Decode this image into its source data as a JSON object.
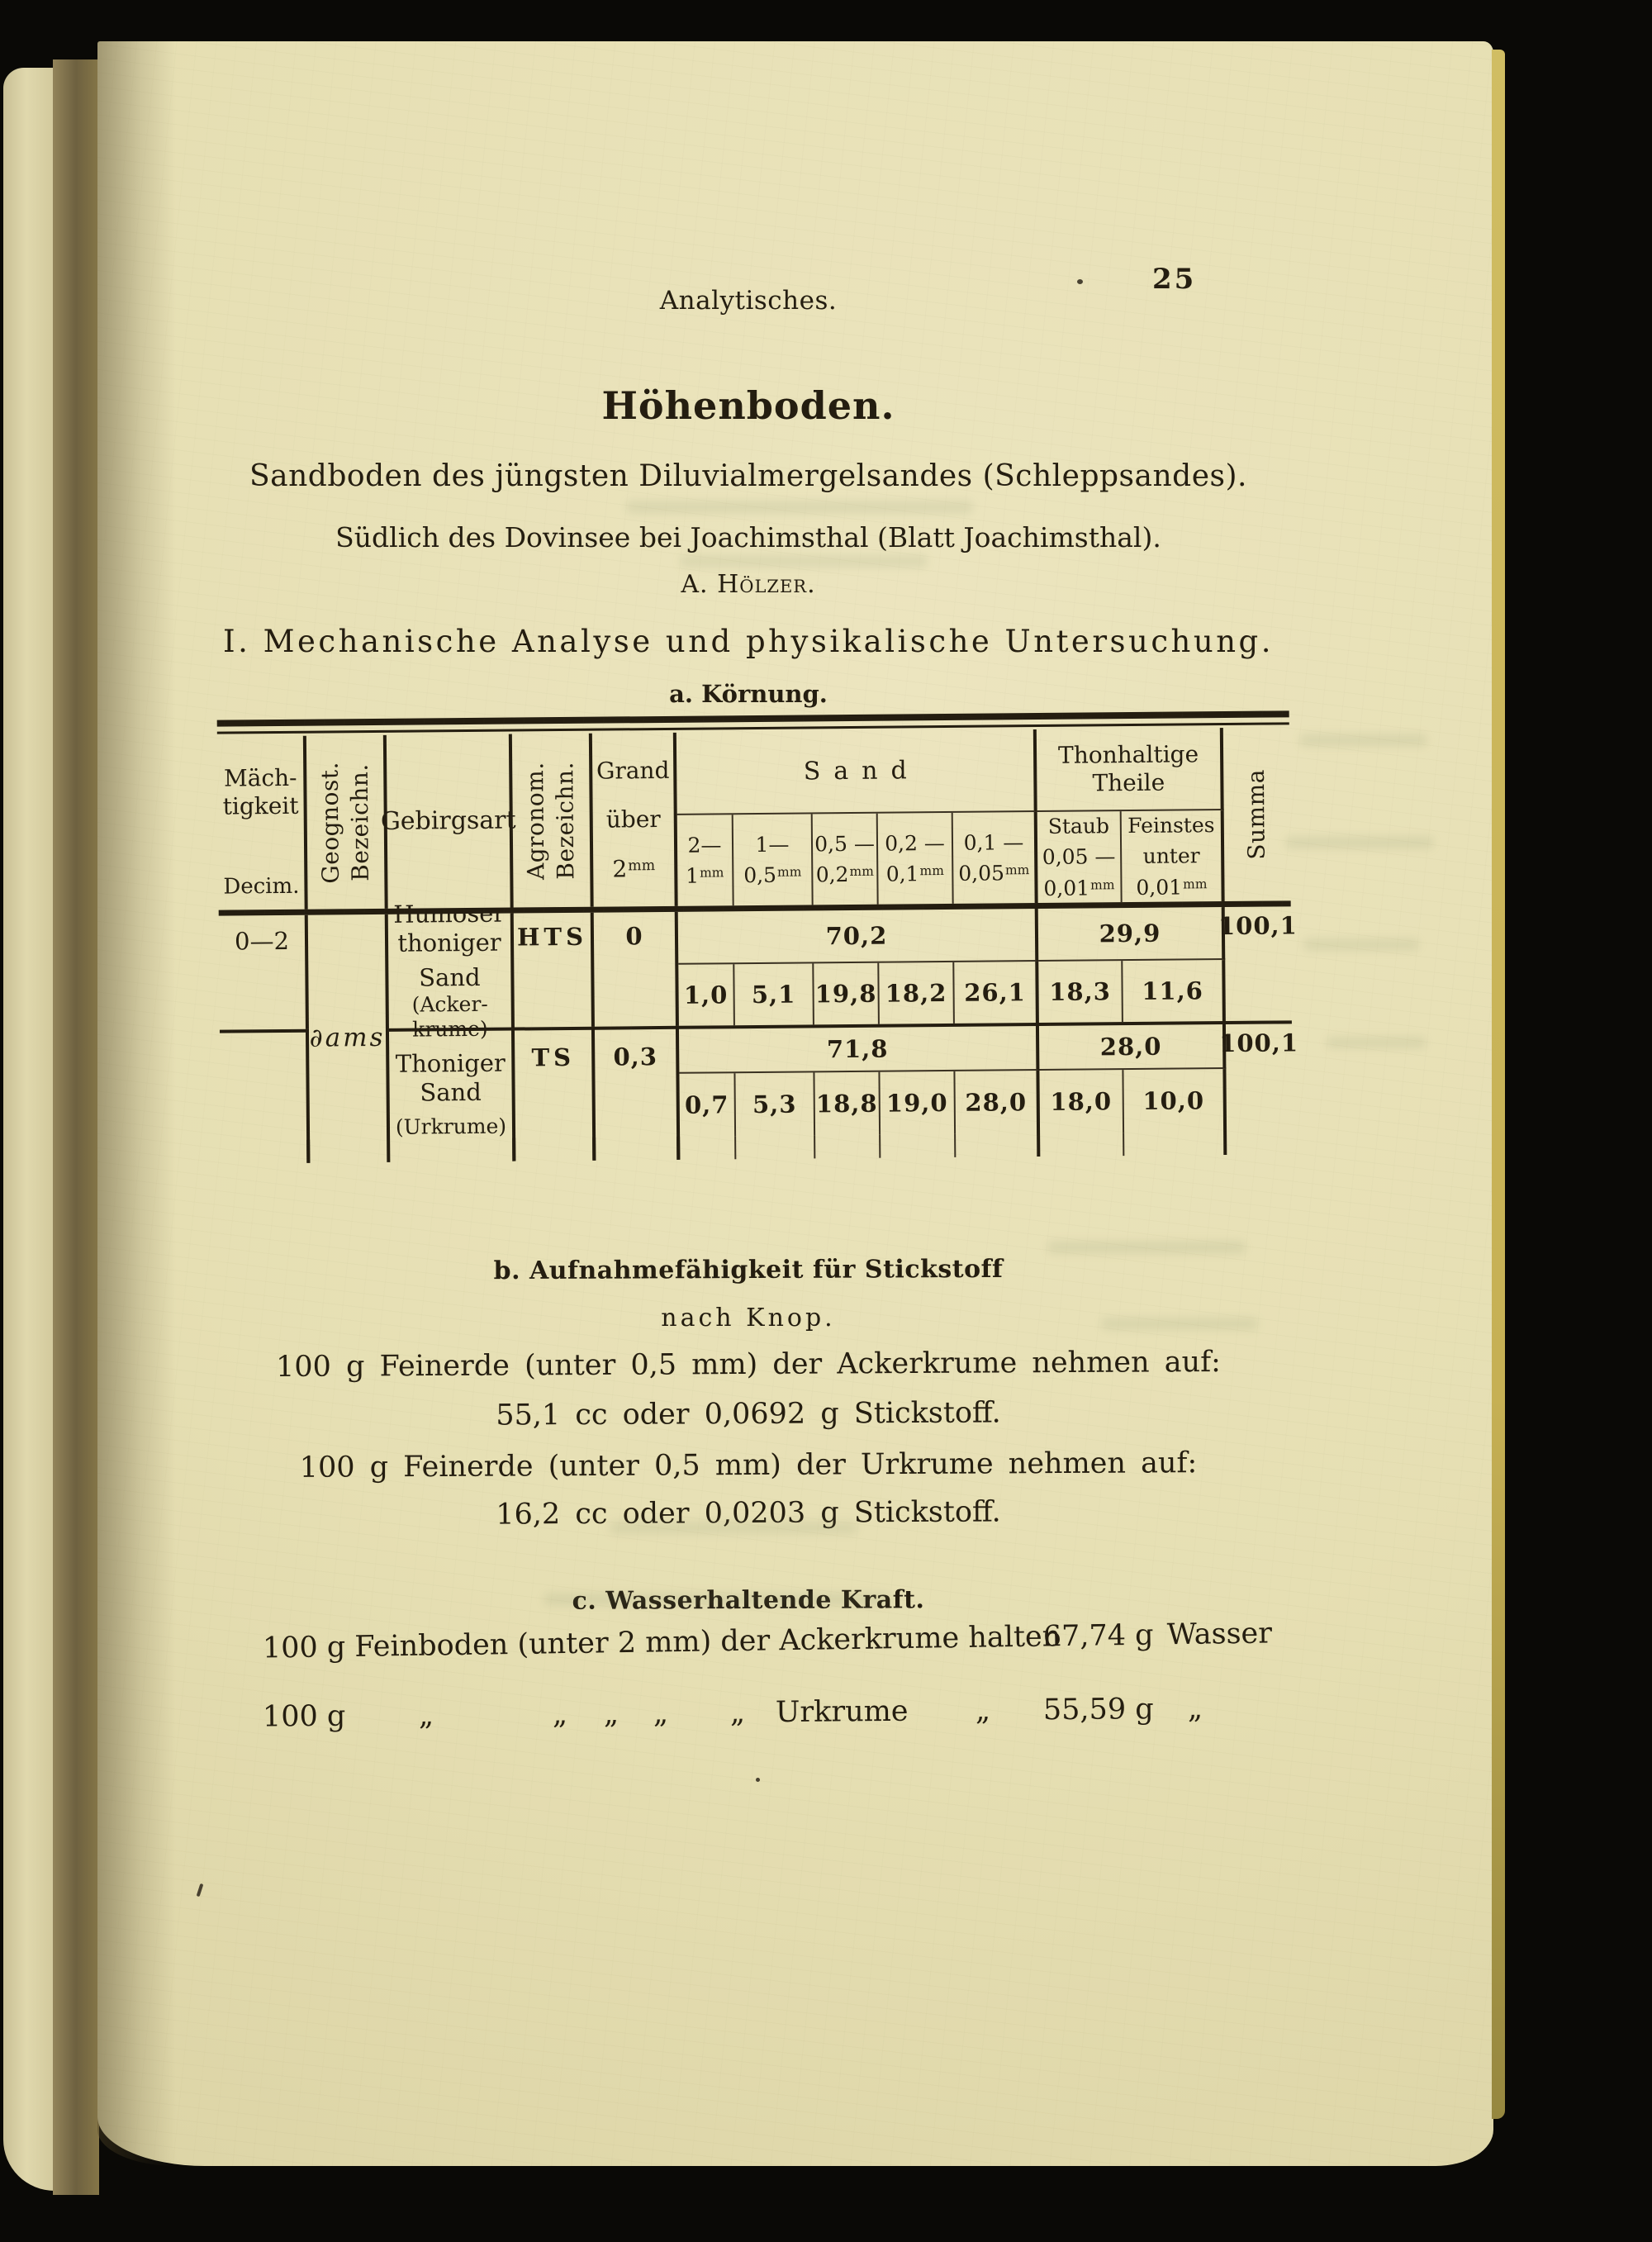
{
  "running_header": {
    "title": "Analytisches.",
    "page_number": "25"
  },
  "heading": {
    "title": "Höhenboden.",
    "subtitle": "Sandboden des jüngsten Diluvialmergelsandes (Schleppsandes).",
    "location": "Südlich des Dovinsee bei Joachimsthal (Blatt Joachimsthal).",
    "author": "A. Hölzer.",
    "section": "I. Mechanische Analyse und physikalische Untersuchung.",
    "subsection": "a. Körnung."
  },
  "table": {
    "headers": {
      "maechtigkeit": {
        "l1": "Mäch-",
        "l2": "tigkeit",
        "l3": "Decim."
      },
      "geognost": {
        "l1": "Geognost.",
        "l2": "Bezeichn."
      },
      "gebirgsart": "Gebirgsart",
      "agronom": {
        "l1": "Agronom.",
        "l2": "Bezeichn."
      },
      "grand": {
        "l1": "Grand",
        "l2": "über",
        "num": "2",
        "unit": "mm"
      },
      "sand_group": "Sand",
      "thon_group": {
        "l1": "Thonhaltige",
        "l2": "Theile"
      },
      "sand_cols": [
        {
          "top": "2—",
          "num": "1",
          "unit": "mm"
        },
        {
          "top": "1—",
          "num": "0,5",
          "unit": "mm"
        },
        {
          "top": "0,5 —",
          "num": "0,2",
          "unit": "mm"
        },
        {
          "top": "0,2 —",
          "num": "0,1",
          "unit": "mm"
        },
        {
          "top": "0,1 —",
          "num": "0,05",
          "unit": "mm"
        }
      ],
      "staub": {
        "l1": "Staub",
        "l2": "0,05 —",
        "num": "0,01",
        "unit": "mm"
      },
      "feinstes": {
        "l1": "Feinstes",
        "l2": "unter",
        "num": "0,01",
        "unit": "mm"
      },
      "summa": "Summa"
    },
    "geognost_value": "∂ams",
    "rows": [
      {
        "maechtigkeit": "0—2",
        "gebirgsart": [
          "Humoser",
          "thoniger",
          "Sand"
        ],
        "gebirgsart_note": [
          "(Acker-",
          "krume)"
        ],
        "agronom": "HTS",
        "grand": "0",
        "sand_total": "70,2",
        "sand_values": [
          "1,0",
          "5,1",
          "19,8",
          "18,2",
          "26,1"
        ],
        "thon_total": "29,9",
        "thon_values": [
          "18,3",
          "11,6"
        ],
        "summa": "100,1"
      },
      {
        "maechtigkeit": "",
        "gebirgsart": [
          "Thoniger",
          "Sand"
        ],
        "gebirgsart_note": [
          "(Urkrume)"
        ],
        "agronom": "TS",
        "grand": "0,3",
        "sand_total": "71,8",
        "sand_values": [
          "0,7",
          "5,3",
          "18,8",
          "19,0",
          "28,0"
        ],
        "thon_total": "28,0",
        "thon_values": [
          "18,0",
          "10,0"
        ],
        "summa": "100,1"
      }
    ]
  },
  "section_b": {
    "heading": "b. Aufnahmefähigkeit für Stickstoff",
    "subheading": "nach Knop.",
    "lines": [
      "100 g Feinerde (unter 0,5 mm) der Ackerkrume nehmen auf:",
      "55,1 cc oder 0,0692 g Stickstoff.",
      "100 g Feinerde (unter 0,5 mm) der Urkrume nehmen auf:",
      "16,2 cc oder 0,0203 g Stickstoff."
    ]
  },
  "section_c": {
    "heading": "c. Wasserhaltende Kraft.",
    "line1": {
      "lead": "100 g Feinboden (unter 2 mm) der Ackerkrume halten",
      "value": "67,74 g",
      "tail": "Wasser"
    },
    "line2": {
      "lead": "100 g",
      "ditto": "„",
      "name": "Urkrume",
      "value": "55,59 g"
    }
  },
  "colors": {
    "paper": "#e6dfb3",
    "ink": "#241d10",
    "page_edge": "#c6b054",
    "background": "#0a0906"
  }
}
